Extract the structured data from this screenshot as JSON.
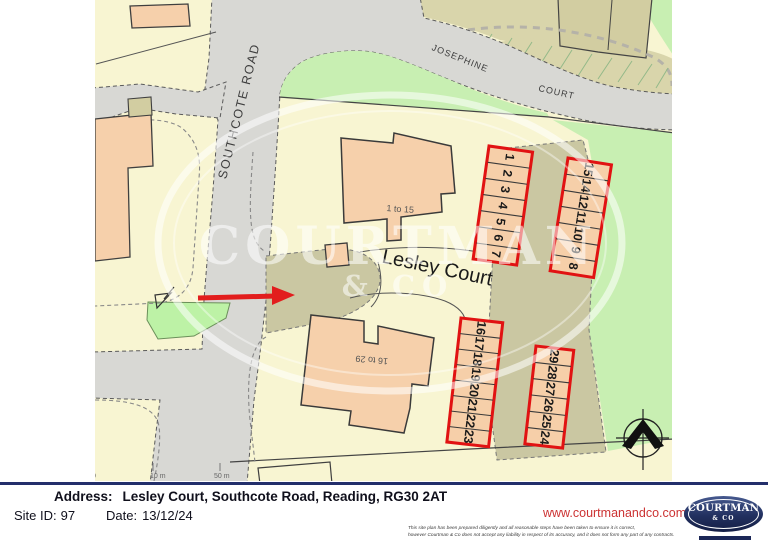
{
  "map": {
    "road_labels": {
      "southcote": "SOUTHCOTE ROAD",
      "josephine_line1": "JOSEPHINE",
      "josephine_line2": "COURT",
      "lesley": "Lesley Court"
    },
    "building_labels": {
      "north": "1 to 15",
      "south": "16 to 29"
    },
    "parking": {
      "row_nw": [
        "1",
        "2",
        "3",
        "4",
        "5",
        "6",
        "7"
      ],
      "row_ne": [
        "15",
        "14",
        "12",
        "11",
        "10",
        "9",
        "8"
      ],
      "row_sw": [
        "16",
        "17",
        "18",
        "19",
        "20",
        "21",
        "22",
        "23"
      ],
      "row_se": [
        "29",
        "28",
        "27",
        "26",
        "25",
        "24"
      ]
    },
    "watermark": {
      "line1": "COURTMAN",
      "line2": "& CO"
    },
    "scale_labels": [
      "0",
      "10 m",
      "50 m"
    ]
  },
  "footer": {
    "address_label": "Address:",
    "address_value": "Lesley Court, Southcote Road, Reading, RG30 2AT",
    "site_id_label": "Site ID:",
    "site_id_value": "97",
    "date_label": "Date:",
    "date_value": "13/12/24",
    "website": "www.courtmanandco.com",
    "disclaimer_line1": "This site plan has been prepared diligently and all reasonable steps have been taken to ensure it is correct,",
    "disclaimer_line2": "however Courtman & Co does not accept any liability in respect of its accuracy, and it does not form any part of any contracts.",
    "logo": {
      "name": "COURTMAN",
      "sub": "& CO"
    }
  },
  "colors": {
    "accent_red": "#e21d1d",
    "parking_outline": "#e11212",
    "navy_bar": "#232f6b",
    "link_red": "#cc3333"
  }
}
